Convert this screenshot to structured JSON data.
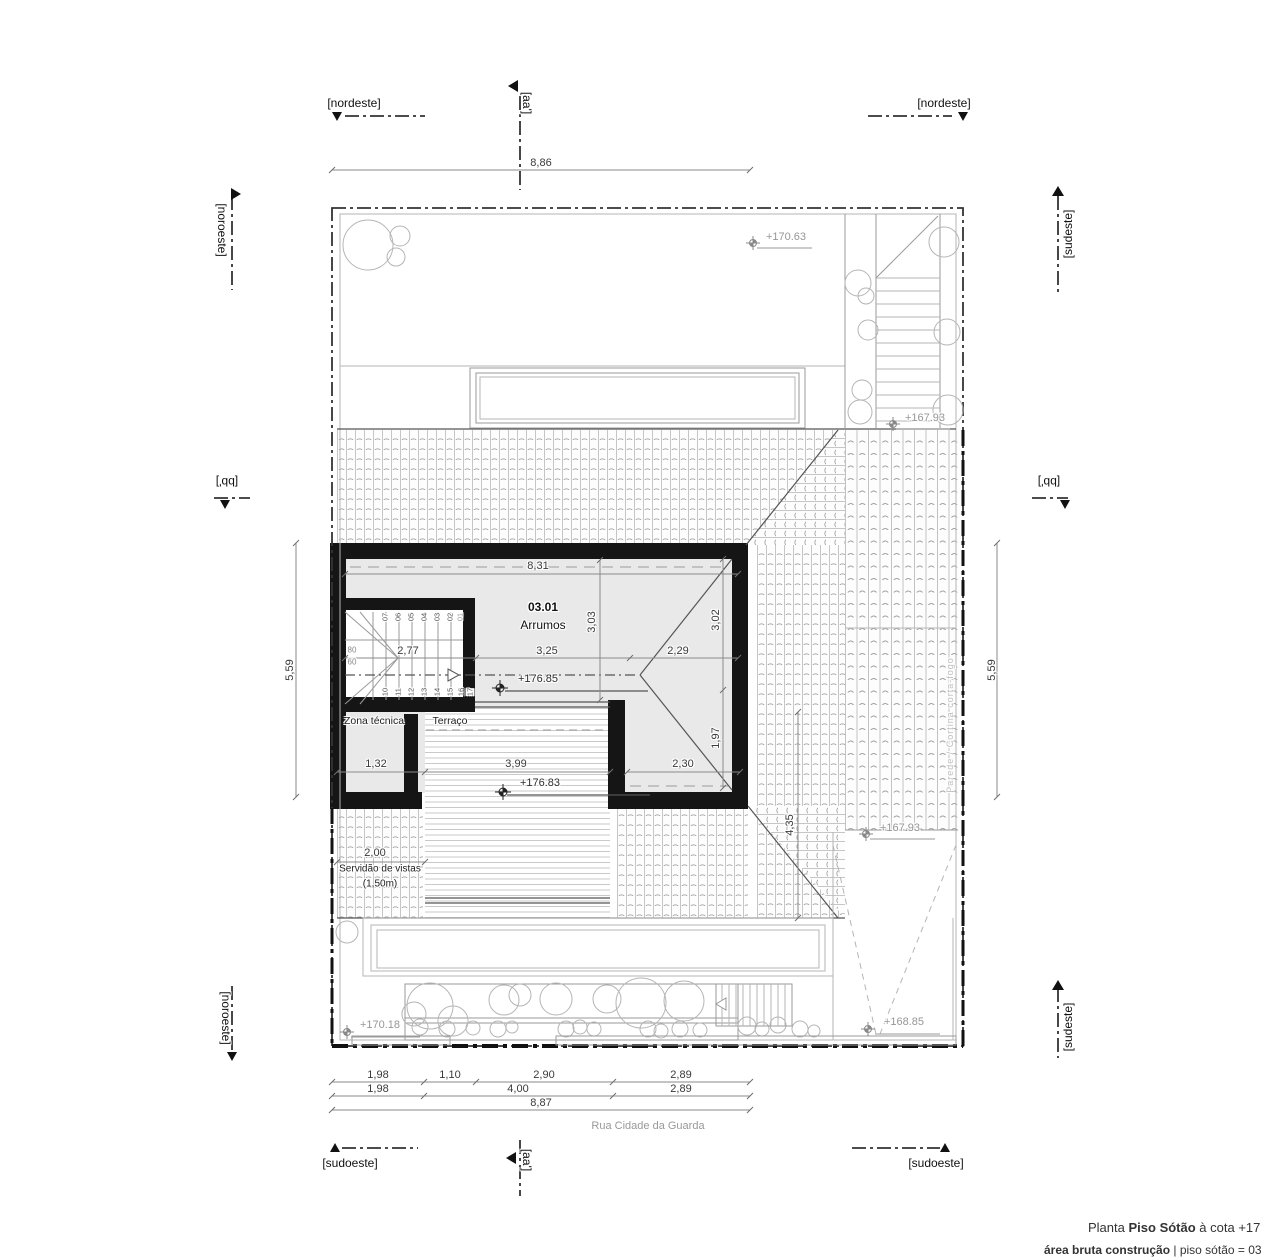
{
  "sheet": {
    "title_prefix": "Planta",
    "title_name": "Piso Sótão",
    "title_suffix": " à cota +17",
    "area_label": "área bruta construção",
    "area_value": " | piso sótão = 03",
    "street": "Rua Cidade da Guarda"
  },
  "markers": {
    "top_left": "[nordeste]",
    "top_right": "[nordeste]",
    "bottom_left": "[sudoeste]",
    "bottom_right": "[sudoeste]",
    "left_top": "[noroeste]",
    "left_bottom": "[noroeste]",
    "right_top": "[sudeste]",
    "right_bottom": "[sudeste]",
    "section_aa": "[aa']",
    "section_bb": "[bb']"
  },
  "rooms": {
    "number": "03.01",
    "name": "Arrumos",
    "zona_tecnica": "Zona técnica",
    "terraco": "Terraço",
    "firewall": "Parede / Cortina corta-fogo",
    "servidao_1": "Servidão de vistas",
    "servidao_2": "(1,50m)"
  },
  "levels": {
    "garden_top": "+170.63",
    "stair_mid": "+167.93",
    "roof_right": "+167.93",
    "attic": "+176.85",
    "terrace": "+176.83",
    "garden_left": "+170.18",
    "driveway": "+168.85"
  },
  "dims": {
    "top": "8,86",
    "side_left": "5,59",
    "side_right": "5,59",
    "room_width": "8,31",
    "stair_run": "2,77",
    "room_mid": "3,25",
    "hip_right": "2,29",
    "room_depth": "3,03",
    "right_upper": "3,02",
    "right_lower": "1,97",
    "leg_width": "2,30",
    "zona_width": "1,32",
    "terrace_width": "3,99",
    "terrace_depth": "4,35",
    "servidao": "2,00",
    "b1a": "1,98",
    "b1b": "1,10",
    "b1c": "2,90",
    "b1d": "2,89",
    "b2a": "1,98",
    "b2b": "4,00",
    "b2c": "2,89",
    "b3": "8,87"
  },
  "stair": {
    "upper": [
      "07",
      "06",
      "05",
      "04",
      "03",
      "02",
      "01"
    ],
    "lower": [
      "10",
      "11",
      "12",
      "13",
      "14",
      "15",
      "16",
      "17"
    ],
    "land_a": "80",
    "land_b": "60"
  },
  "colors": {
    "wall": "#151515",
    "hatch_line": "#adadad",
    "dim_text": "#3a3a3a",
    "level_text": "#979797"
  }
}
